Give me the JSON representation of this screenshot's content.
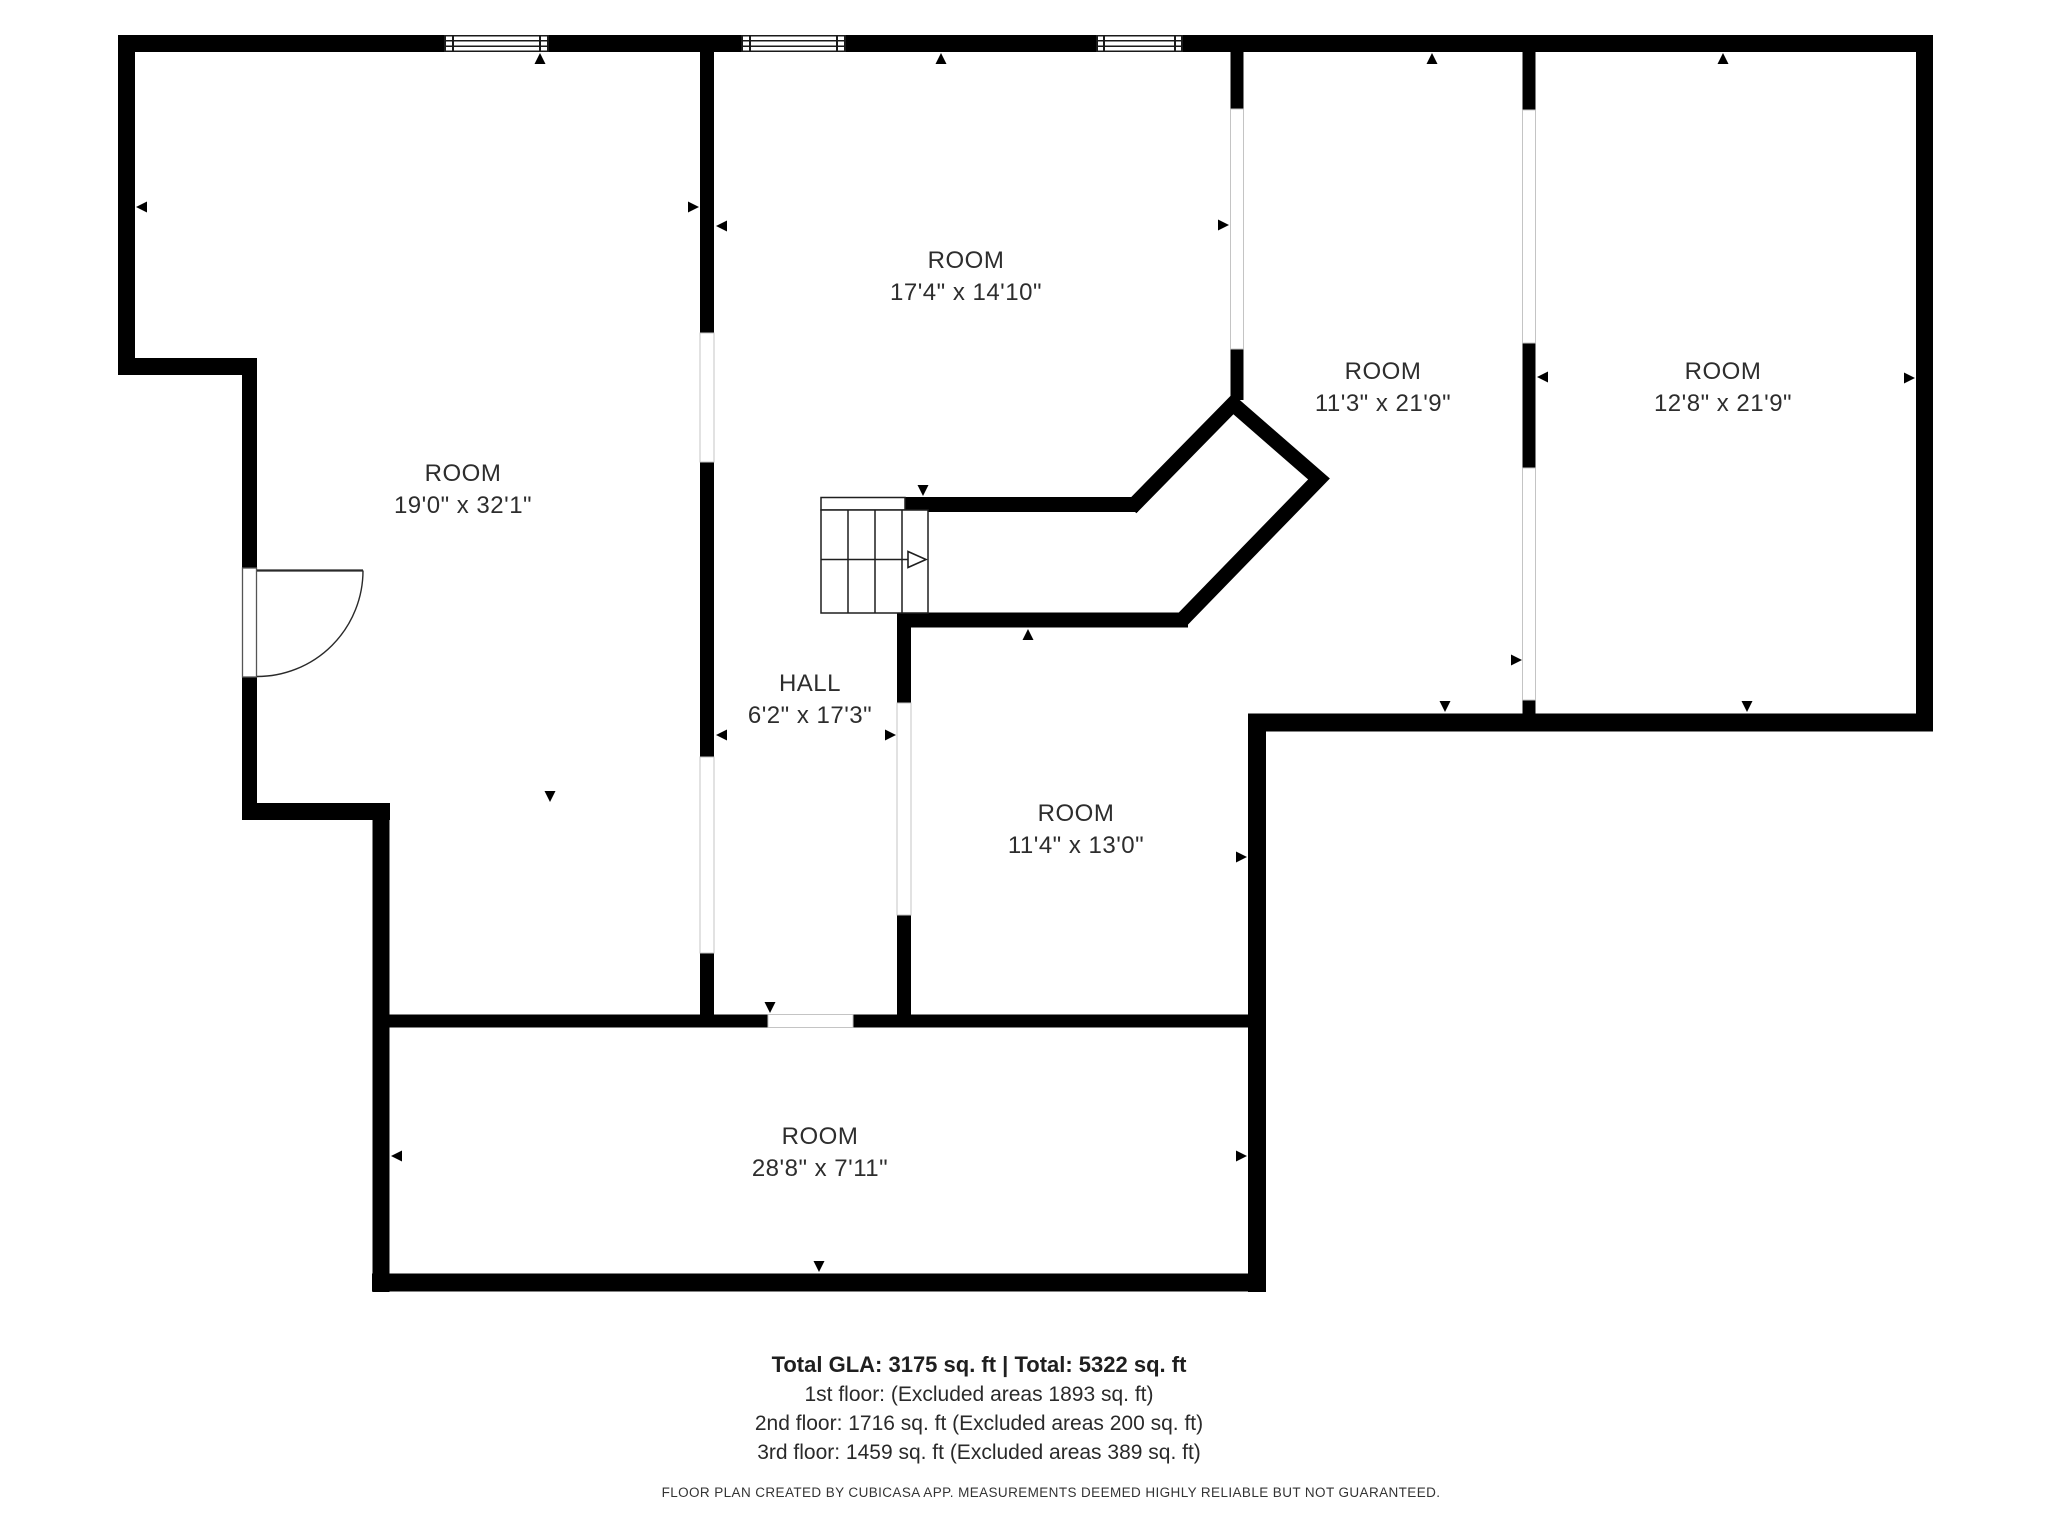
{
  "floorplan": {
    "creator_note": "FLOOR PLAN CREATED BY CUBICASA APP. MEASUREMENTS DEEMED HIGHLY RELIABLE BUT NOT GUARANTEED.",
    "rooms": [
      {
        "id": "room-top-middle",
        "name": "ROOM",
        "dims": "17'4\" x 14'10\""
      },
      {
        "id": "room-upper-right-inner",
        "name": "ROOM",
        "dims": "11'3\" x 21'9\""
      },
      {
        "id": "room-upper-right-outer",
        "name": "ROOM",
        "dims": "12'8\" x 21'9\""
      },
      {
        "id": "room-left",
        "name": "ROOM",
        "dims": "19'0\" x 32'1\""
      },
      {
        "id": "hall",
        "name": "HALL",
        "dims": "6'2\" x 17'3\""
      },
      {
        "id": "room-middle",
        "name": "ROOM",
        "dims": "11'4\" x 13'0\""
      },
      {
        "id": "room-bottom",
        "name": "ROOM",
        "dims": "28'8\" x 7'11\""
      }
    ]
  },
  "footer": {
    "totals": "Total GLA: 3175 sq. ft | Total: 5322 sq. ft",
    "floor1": "1st floor: (Excluded areas 1893 sq. ft)",
    "floor2": "2nd floor: 1716 sq. ft (Excluded areas 200 sq. ft)",
    "floor3": "3rd floor: 1459 sq. ft (Excluded areas 389 sq. ft)",
    "disclaimer": "FLOOR PLAN CREATED BY CUBICASA APP. MEASUREMENTS DEEMED HIGHLY RELIABLE BUT NOT GUARANTEED."
  },
  "colors": {
    "wall": "#000000",
    "text": "#2d2d2d",
    "opening_edge": "#c4c4c4",
    "background": "#ffffff"
  }
}
